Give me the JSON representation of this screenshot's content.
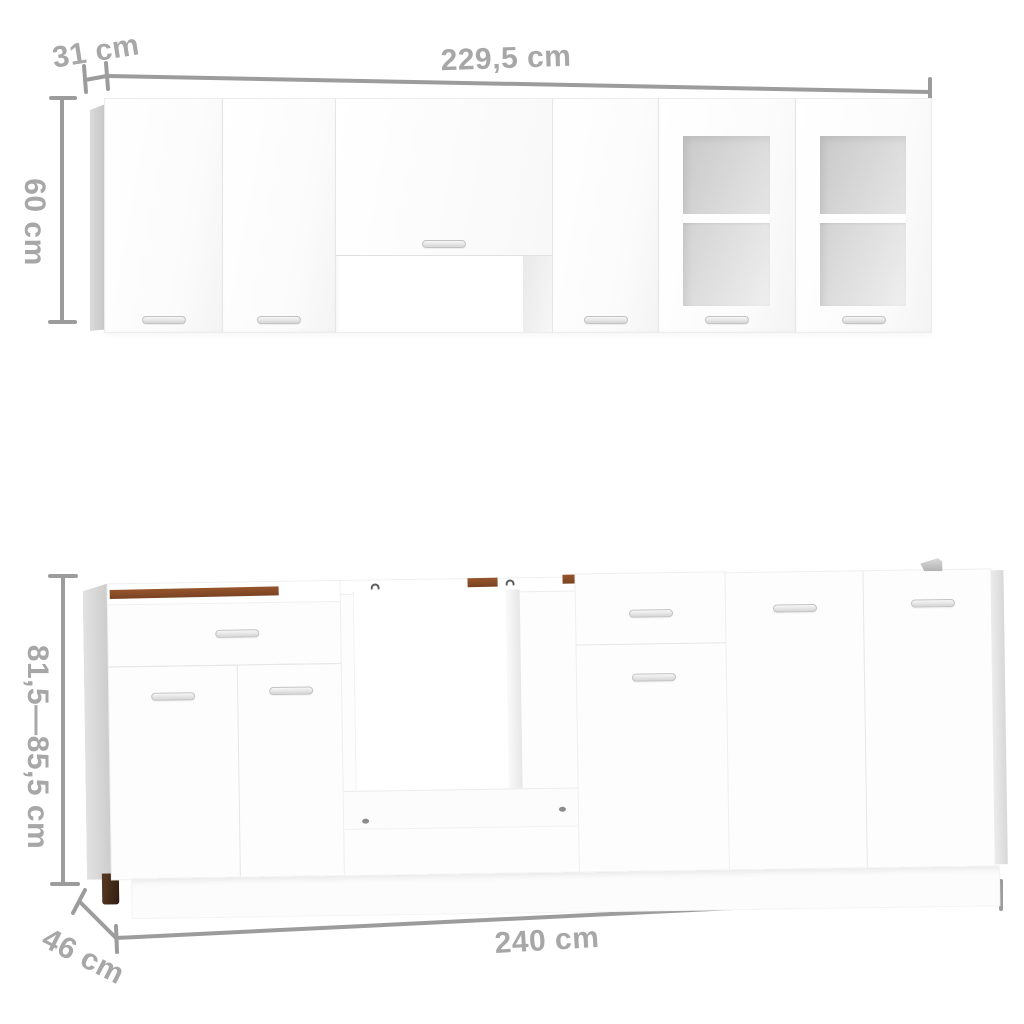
{
  "diagram": {
    "background": "#ffffff",
    "line_color": "#9c9c9c",
    "label_color": "#a7a7a7",
    "cabinet_color": "#fdfdfd",
    "side_panel_color": "#cccccc",
    "glass_color": "#d9d9d9",
    "wood_edge_color": "#8a4c28",
    "foot_color": "#3a2416",
    "labels": {
      "wall_depth": "31 cm",
      "wall_width": "229,5 cm",
      "wall_height": "60 cm",
      "base_height": "81,5—85,5 cm",
      "base_depth": "46 cm",
      "base_width": "240 cm"
    }
  }
}
